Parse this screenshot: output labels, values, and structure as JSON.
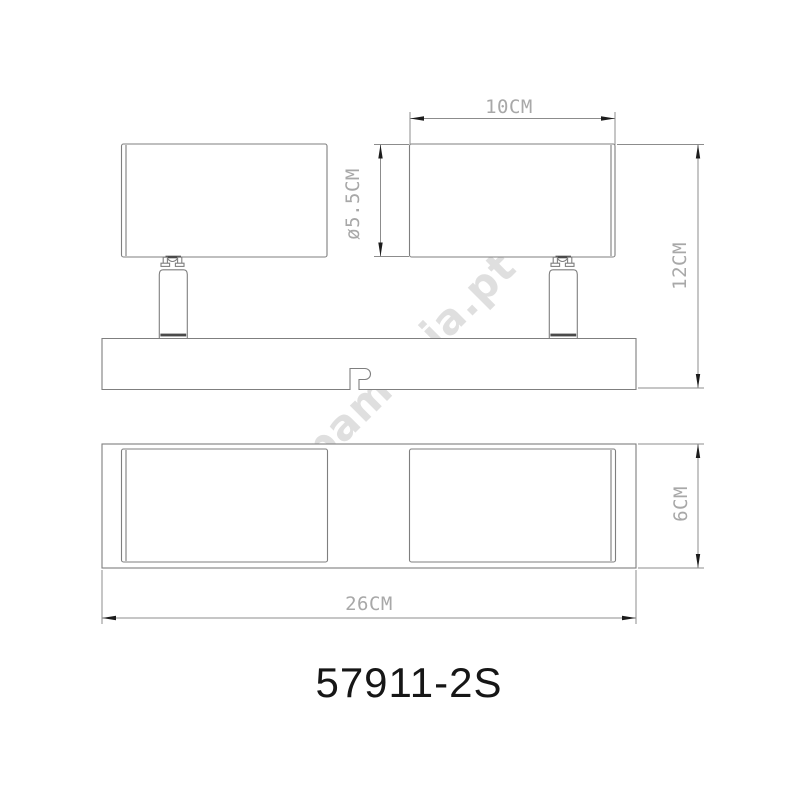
{
  "drawing": {
    "model_number": "57911-2S",
    "watermark": "lampamania.pt",
    "views": {
      "front_view": {
        "dim_head_width": "10CM",
        "dim_head_diameter": "ø5.5CM",
        "dim_total_height": "12CM"
      },
      "bottom_view": {
        "dim_base_depth": "6CM",
        "dim_base_width": "26CM"
      }
    },
    "colors": {
      "line": "#7f7f7f",
      "dim_line": "#8c8c8c",
      "dim_text": "#a8a8a8",
      "arrow": "#1c1c1c",
      "model_text": "#161616",
      "watermark": "#dfdfdf",
      "background": "#ffffff"
    }
  }
}
